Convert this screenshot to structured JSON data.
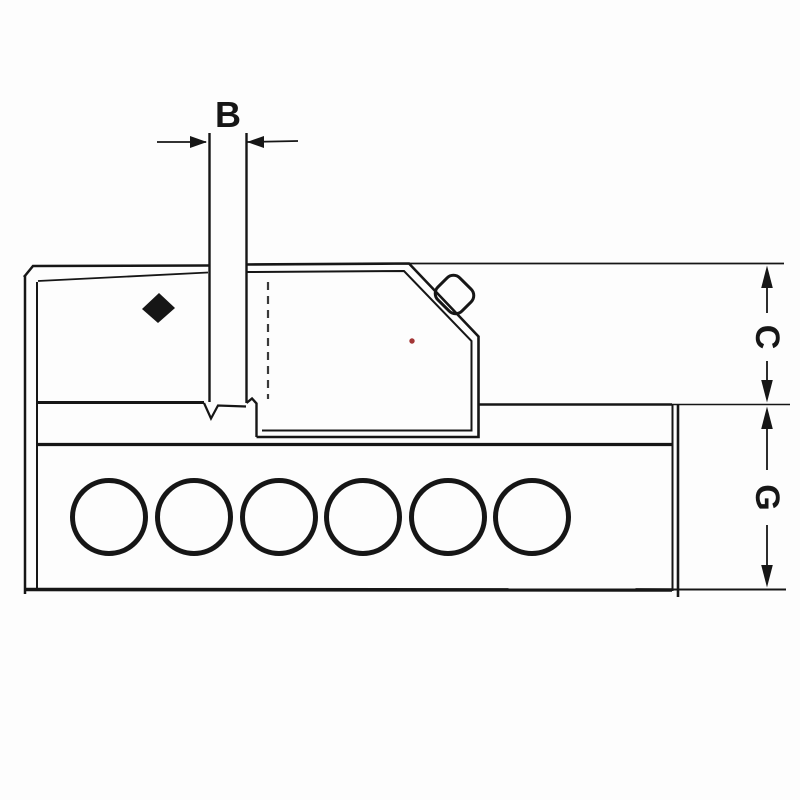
{
  "diagram": {
    "kind": "side-view technical line drawing of a machine vise",
    "labels": {
      "b": "B",
      "c": "C",
      "g": "G"
    },
    "colors": {
      "line": "#161616",
      "background": "#fdfdfd",
      "dashed_line": "#3a3a3a",
      "red_dot": "#a33636"
    },
    "holes": {
      "count": 6
    },
    "icons": {
      "diamond_marker": "solid diamond pointer inside fixed jaw block"
    }
  }
}
